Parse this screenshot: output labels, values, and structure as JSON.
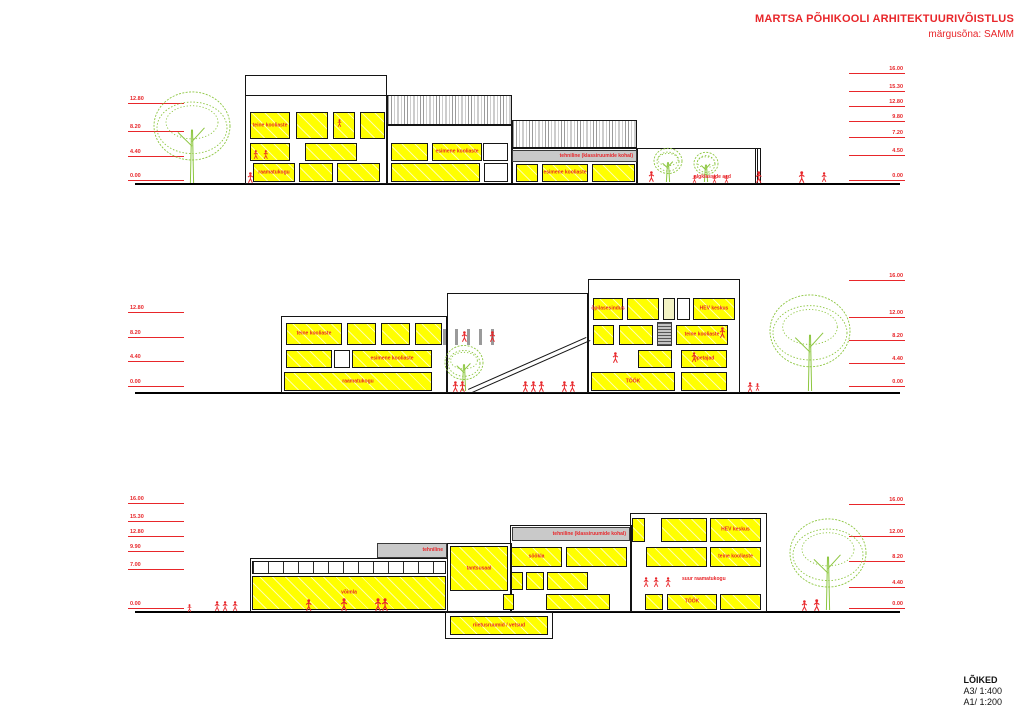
{
  "header": {
    "title": "MARTSA PÕHIKOOLI ARHITEKTUURIVÕISTLUS",
    "subtitle": "märgusõna: SAMM"
  },
  "footer": {
    "title": "LÕIKED",
    "scale_a3": "A3/ 1:400",
    "scale_a1": "A1/ 1:200"
  },
  "accent_colors": {
    "red": "#e8262a",
    "yellow": "#ffff00",
    "green": "#8cc63f",
    "gray": "#c9c9c9"
  },
  "sections": [
    {
      "id": "section-1",
      "left_elevations": [
        "12.80",
        "8.20",
        "4.40",
        "0.00"
      ],
      "right_elevations": [
        "16.00",
        "15.30",
        "12.80",
        "9.80",
        "7.20",
        "4.50",
        "0.00"
      ],
      "rooms": [
        "teine kooliaste",
        "esimene kooliaste",
        "raamatukogu",
        "esimene kooliaste",
        "tehniline (klassiruumide kohal)",
        "algklasside aed"
      ]
    },
    {
      "id": "section-2",
      "left_elevations": [
        "12.80",
        "8.20",
        "4.40",
        "0.00"
      ],
      "right_elevations": [
        "16.00",
        "12.00",
        "8.20",
        "4.40",
        "0.00"
      ],
      "rooms": [
        "teine kooliaste",
        "esimene kooliaste",
        "raamatukogu",
        "õpilasesindus",
        "HEV keskus",
        "teine kooliaste",
        "õpetajad",
        "TÖÖK"
      ]
    },
    {
      "id": "section-3",
      "left_elevations": [
        "16.00",
        "15.30",
        "12.80",
        "9.90",
        "7.00",
        "0.00"
      ],
      "right_elevations": [
        "16.00",
        "12.00",
        "8.20",
        "4.40",
        "0.00"
      ],
      "rooms": [
        "võimla",
        "tehniline",
        "tehniline (klassiruumide kohal)",
        "HEV keskus",
        "söökla",
        "teine kooliaste",
        "tantsusaal",
        "suur raamatukogu",
        "TÖÖK",
        "riietusruumid / vetsud"
      ]
    }
  ]
}
